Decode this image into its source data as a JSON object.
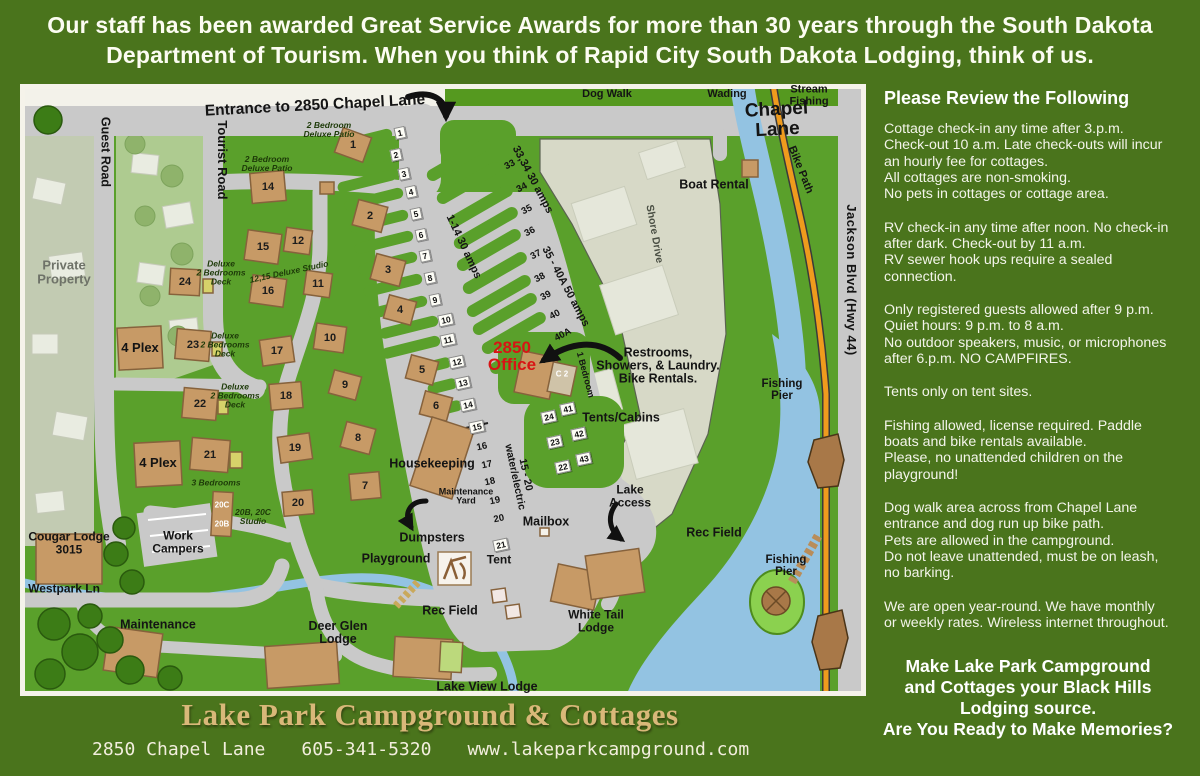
{
  "header": {
    "text": "Our staff has been awarded Great Service Awards for more than 30 years through the South Dakota\nDepartment of Tourism.  When you think of Rapid City South Dakota Lodging, think of us."
  },
  "sidebar": {
    "title": "Please Review the Following",
    "paragraphs": [
      "Cottage check-in any time after 3.p.m.\nCheck-out 10 a.m. Late check-outs will incur\nan hourly fee for cottages.\nAll cottages are non-smoking.\nNo pets in cottages or cottage area.",
      "RV check-in any time after noon. No check-in\nafter dark. Check-out by 11 a.m.\nRV sewer hook ups require a sealed\nconnection.",
      "Only registered guests allowed after 9 p.m.\nQuiet hours: 9 p.m. to 8 a.m.\nNo outdoor speakers, music, or microphones\nafter 6.p.m.  NO CAMPFIRES.",
      "Tents only on tent sites.",
      "Fishing allowed, license required. Paddle\nboats and bike rentals available.\nPlease, no unattended children on the\nplayground!",
      "Dog walk area across from Chapel Lane\nentrance and dog run up bike path.\nPets are allowed in the campground.\nDo not leave unattended, must be on leash,\nno barking.",
      "We are open year-round. We have monthly\nor weekly rates. Wireless internet throughout."
    ],
    "closing": "Make Lake Park Campground\nand Cottages your Black Hills\nLodging source.\nAre You Ready to Make Memories?"
  },
  "footer": {
    "title": "Lake Park Campground & Cottages",
    "address": "2850 Chapel Lane",
    "phone": "605-341-5320",
    "website": "www.lakeparkcampground.com"
  },
  "map": {
    "top": {
      "dog_walk": "Dog Walk",
      "wading": "Wading",
      "stream_fishing": "Stream Fishing"
    },
    "roads": {
      "entrance": "Entrance to 2850 Chapel Lane",
      "chapel_lane": "Chapel Lane",
      "jackson": "Jackson Blvd  (Hwy 44)",
      "guest": "Guest Road",
      "tourist": "Tourist Road",
      "bike_path": "Bike Path",
      "shore_drive": "Shore Drive",
      "westpark": "Westpark Ln"
    },
    "labels": {
      "private_property": "Private\nProperty",
      "boat_rental": "Boat Rental",
      "office": "2850\nOffice",
      "restrooms": "Restrooms,\nShowers, & Laundry.\nBike Rentals.",
      "tents_cabins": "Tents/Cabins",
      "one_bedroom": "1 Bedroom",
      "c2": "C 2",
      "lake_access": "Lake\nAccess",
      "mailbox": "Mailbox",
      "dumpsters": "Dumpsters",
      "playground": "Playground",
      "tent": "Tent",
      "rec_field": "Rec Field",
      "housekeeping": "Housekeeping",
      "maintenance_yard": "Maintenance\nYard",
      "work_campers": "Work\nCampers",
      "maintenance": "Maintenance",
      "cougar_lodge": "Cougar Lodge\n3015",
      "deer_glen": "Deer Glen\nLodge",
      "lake_view": "Lake View Lodge",
      "white_tail": "White Tail\nLodge",
      "fishing_pier": "Fishing\nPier",
      "four_plex": "4 Plex"
    },
    "site_notes": {
      "amps_1_14": "1-14  30 amps",
      "amps_33_34": "33,34  30 amps",
      "amps_35_40": "35 - 40A  50 amps",
      "water_electric": "15 - 20\nwater/electric",
      "patio": "2 Bedroom\nDeluxe Patio",
      "deck": "Deluxe\n2 Bedrooms\nDeck",
      "studio_12_15": "12,15 Deluxe Studio",
      "three_bedrooms": "3 Bedrooms",
      "studio_20": "20B, 20C\nStudio"
    },
    "cottages": {
      "n1": "1",
      "n2": "2",
      "n3": "3",
      "n4": "4",
      "n5": "5",
      "n6": "6",
      "n7": "7",
      "n8": "8",
      "n9": "9",
      "n10": "10",
      "n11": "11",
      "n12": "12",
      "n14": "14",
      "n15": "15",
      "n16": "16",
      "n17": "17",
      "n18": "18",
      "n19": "19",
      "n20": "20",
      "n21": "21",
      "n22": "22",
      "n23": "23",
      "n24": "24",
      "b20c": "20C",
      "b20b": "20B"
    },
    "rv_sites": [
      "1",
      "2",
      "3",
      "4",
      "5",
      "6",
      "7",
      "8",
      "9",
      "10",
      "11",
      "12",
      "13",
      "14",
      "15",
      "16",
      "17",
      "18",
      "19",
      "20",
      "21"
    ],
    "rv_sites_right": [
      "33",
      "34",
      "35",
      "36",
      "37",
      "38",
      "39",
      "40",
      "40A"
    ],
    "tent_sites": [
      "24",
      "41",
      "23",
      "42",
      "22",
      "43"
    ]
  },
  "colors": {
    "background": "#4a741c",
    "map_green": "#5aa02b",
    "road_gray": "#c9c9c9",
    "water_blue": "#93c3e2",
    "bike_path_orange": "#ef9b1d",
    "building_tan": "#c79a66",
    "office_red": "#d81414",
    "footer_gold": "#d9b879"
  }
}
